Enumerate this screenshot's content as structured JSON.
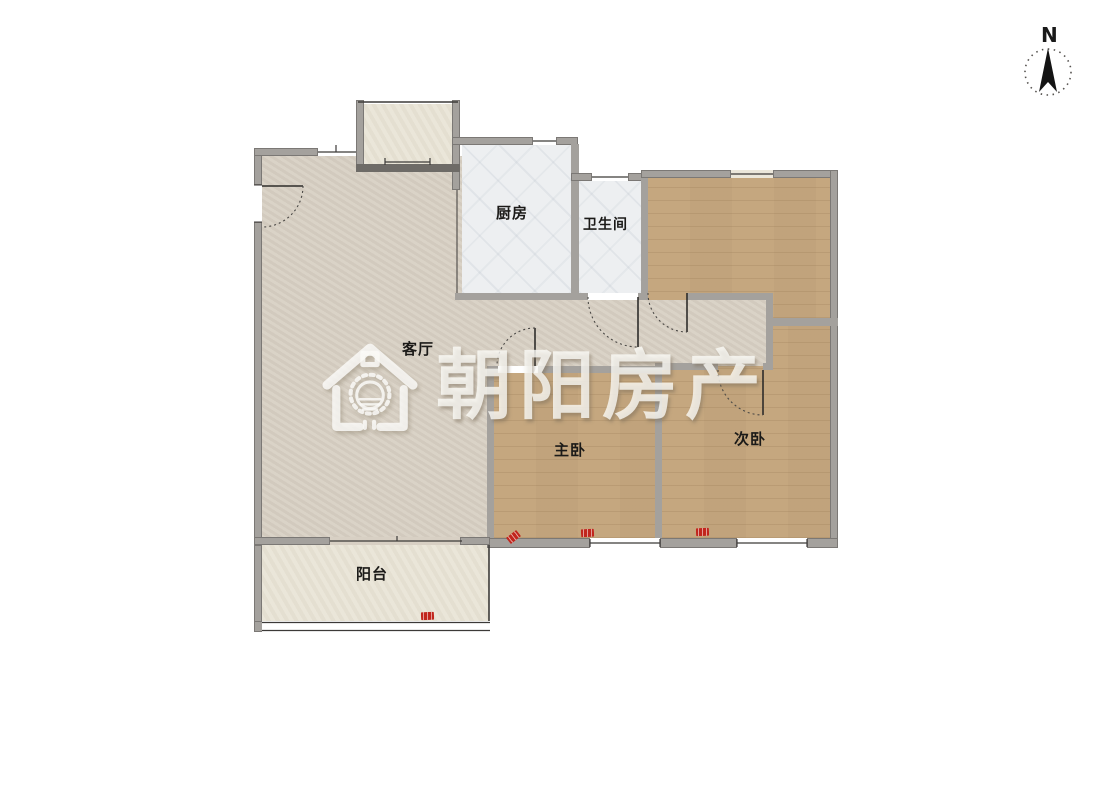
{
  "compass": {
    "label": "N"
  },
  "watermark": {
    "text": "朝阳房产"
  },
  "rooms": {
    "living": {
      "label": "客厅"
    },
    "kitchen": {
      "label": "厨房"
    },
    "bathroom": {
      "label": "卫生间"
    },
    "master": {
      "label": "主卧"
    },
    "second": {
      "label": "次卧"
    },
    "balcony": {
      "label": "阳台"
    }
  },
  "markers": {
    "ac_unit_color": "#c1261d",
    "count": 4
  },
  "palette": {
    "wall": "#a4a19d",
    "floor_living": "#d8d0c4",
    "floor_wood": "#c9ab83",
    "floor_tile": "#edeff1",
    "floor_balcony": "#e9e4d6",
    "watermark": "rgba(253,252,248,0.78)",
    "line": "#3c3a38"
  }
}
